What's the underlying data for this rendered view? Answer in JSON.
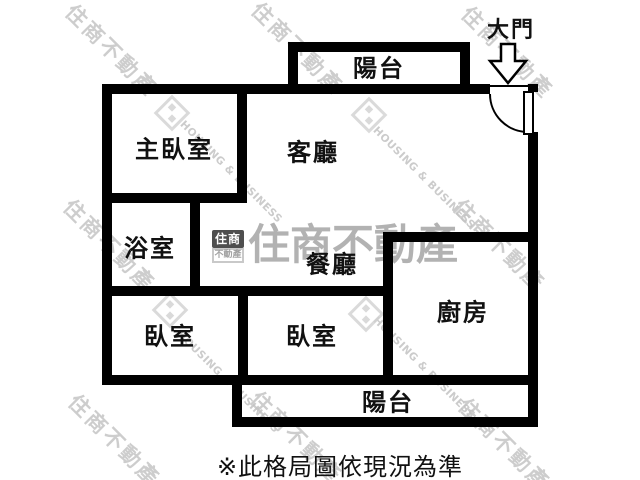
{
  "floor_plan": {
    "entrance_label": "大門",
    "disclaimer": "※此格局圖依現況為準",
    "rooms": {
      "balcony_top": "陽台",
      "master_bedroom": "主臥室",
      "living_room": "客廳",
      "bathroom": "浴室",
      "dining_room": "餐廳",
      "kitchen": "廚房",
      "bedroom_left": "臥室",
      "bedroom_middle": "臥室",
      "balcony_bottom": "陽台"
    }
  },
  "watermark": {
    "brand_cn": "住商不動產",
    "brand_en": "HOUSING & BUSINESS",
    "logo_top": "住商",
    "logo_bottom": "不動產"
  },
  "colors": {
    "wall": "#000000",
    "background": "#ffffff",
    "watermark_gray": "#bdbdbd",
    "center_watermark_gray": "#9f9f9f"
  }
}
